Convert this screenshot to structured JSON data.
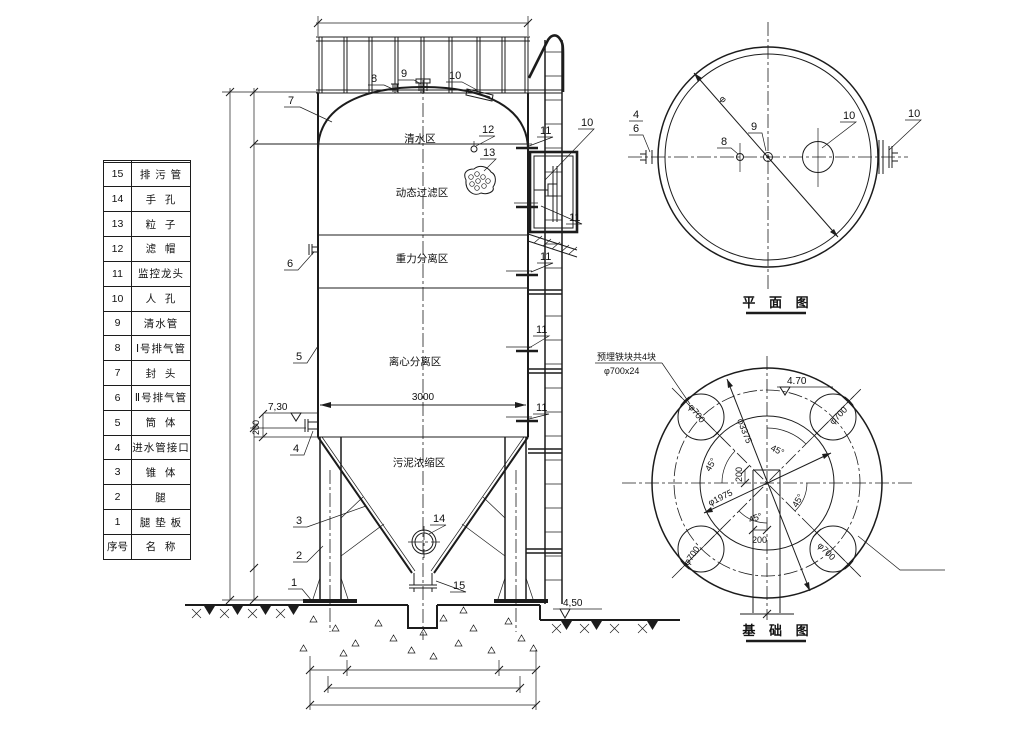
{
  "drawing": {
    "bg": "#ffffff",
    "ink": "#1c1c1c"
  },
  "parts_table": {
    "rows": [
      {
        "no": "",
        "name": ""
      },
      {
        "no": "15",
        "name": "排 污 管"
      },
      {
        "no": "14",
        "name": "手  孔"
      },
      {
        "no": "13",
        "name": "粒  子"
      },
      {
        "no": "12",
        "name": "滤  帽"
      },
      {
        "no": "11",
        "name": "监控龙头"
      },
      {
        "no": "10",
        "name": "人  孔"
      },
      {
        "no": "9",
        "name": "清水管"
      },
      {
        "no": "8",
        "name": "Ⅰ号排气管"
      },
      {
        "no": "7",
        "name": "封  头"
      },
      {
        "no": "6",
        "name": "Ⅱ号排气管"
      },
      {
        "no": "5",
        "name": "筒  体"
      },
      {
        "no": "4",
        "name": "进水管接口"
      },
      {
        "no": "3",
        "name": "锥  体"
      },
      {
        "no": "2",
        "name": "腿"
      },
      {
        "no": "1",
        "name": "腿 垫 板"
      },
      {
        "no": "序号",
        "name": "名  称"
      }
    ]
  },
  "labels": {
    "n1": "1",
    "n2": "2",
    "n3": "3",
    "n4": "4",
    "n5": "5",
    "n6": "6",
    "n7": "7",
    "n8": "8",
    "n9": "9",
    "n10": "10",
    "n11": "11",
    "n12": "12",
    "n13": "13",
    "n14": "14",
    "n15": "15"
  },
  "elevation": {
    "zones": [
      "清水区",
      "动态过滤区",
      "重力分离区",
      "离心分离区",
      "污泥浓缩区"
    ],
    "dim_width": "3000",
    "level_top": "7,30",
    "offset_200": "200",
    "level_ground": "4,50"
  },
  "plan": {
    "title": "平 面 图",
    "phi": "φ"
  },
  "foundation": {
    "title": "基 础 图",
    "note1": "预埋铁块共4块",
    "note2": "φ700x24",
    "dia_main": "φ3375",
    "dia_bolt": "φ1975",
    "dia_plate": "φ700",
    "angle45": "45°",
    "dim_200": "200",
    "level": "4.70"
  }
}
